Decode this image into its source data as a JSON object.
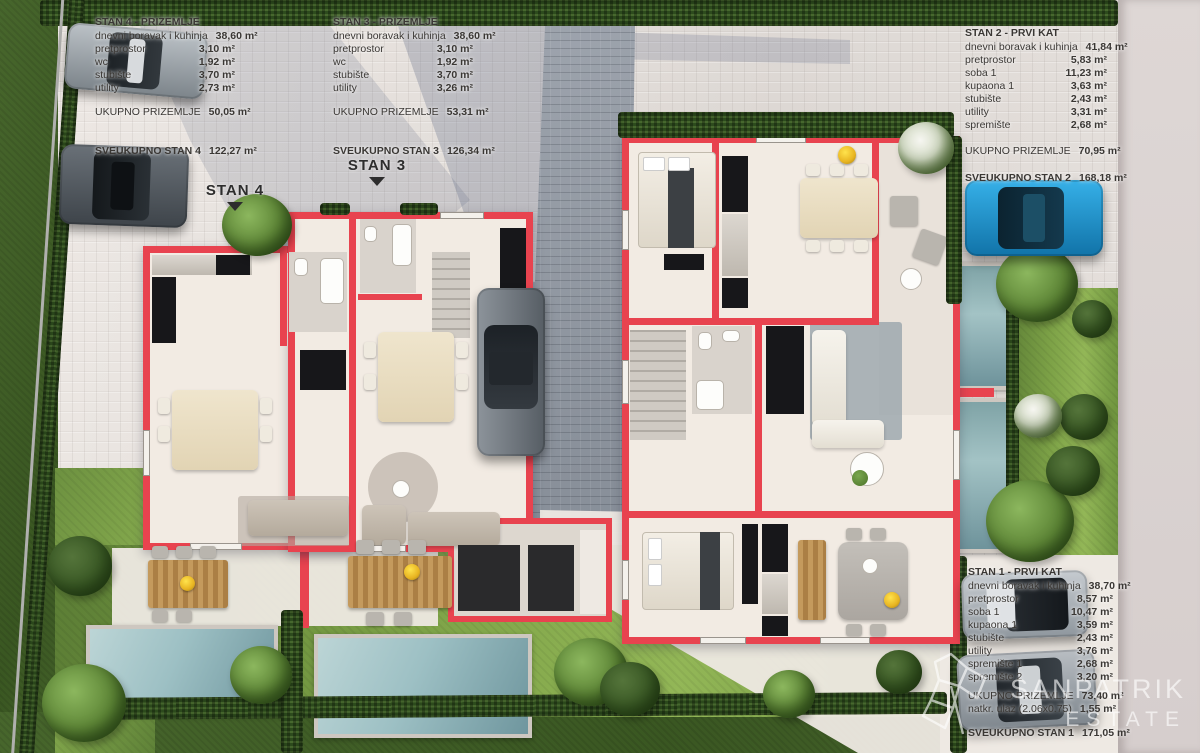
{
  "tables": {
    "stan4": {
      "title": "STAN 4 - PRIZEMLJE",
      "rows": [
        {
          "label": "dnevni boravak i kuhinja",
          "value": "38,60 m²"
        },
        {
          "label": "pretprostor",
          "value": "3,10 m²"
        },
        {
          "label": "wc",
          "value": "1,92 m²"
        },
        {
          "label": "stubište",
          "value": "3,70 m²"
        },
        {
          "label": "utility",
          "value": "2,73 m²"
        }
      ],
      "subtotal": {
        "label": "UKUPNO PRIZEMLJE",
        "value": "50,05 m²"
      },
      "total": {
        "label": "SVEUKUPNO STAN 4",
        "value": "122,27 m²"
      }
    },
    "stan3": {
      "title": "STAN 3 - PRIZEMLJE",
      "rows": [
        {
          "label": "dnevni boravak i kuhinja",
          "value": "38,60 m²"
        },
        {
          "label": "pretprostor",
          "value": "3,10 m²"
        },
        {
          "label": "wc",
          "value": "1,92 m²"
        },
        {
          "label": "stubište",
          "value": "3,70 m²"
        },
        {
          "label": "utility",
          "value": "3,26 m²"
        }
      ],
      "subtotal": {
        "label": "UKUPNO PRIZEMLJE",
        "value": "53,31 m²"
      },
      "total": {
        "label": "SVEUKUPNO STAN 3",
        "value": "126,34 m²"
      }
    },
    "stan2": {
      "title": "STAN 2 - PRVI KAT",
      "rows": [
        {
          "label": "dnevni boravak i kuhinja",
          "value": "41,84 m²"
        },
        {
          "label": "pretprostor",
          "value": "5,83 m²"
        },
        {
          "label": "soba 1",
          "value": "11,23 m²"
        },
        {
          "label": "kupaona 1",
          "value": "3,63 m²"
        },
        {
          "label": "stubište",
          "value": "2,43 m²"
        },
        {
          "label": "utility",
          "value": "3,31 m²"
        },
        {
          "label": "spremište",
          "value": "2,68 m²"
        }
      ],
      "subtotal": {
        "label": "UKUPNO PRIZEMLJE",
        "value": "70,95 m²"
      },
      "total": {
        "label": "SVEUKUPNO STAN 2",
        "value": "168,18 m²"
      }
    },
    "stan1": {
      "title": "STAN 1 - PRVI KAT",
      "rows": [
        {
          "label": "dnevni boravak i kuhinja",
          "value": "38,70 m²"
        },
        {
          "label": "pretprostor",
          "value": "8,57 m²"
        },
        {
          "label": "soba 1",
          "value": "10,47 m²"
        },
        {
          "label": "kupaona 1",
          "value": "3,59 m²"
        },
        {
          "label": "stubište",
          "value": "2,43 m²"
        },
        {
          "label": "utility",
          "value": "3,76 m²"
        },
        {
          "label": "spremište 1",
          "value": "2,68 m²"
        },
        {
          "label": "spremište 2",
          "value": "3,20 m²"
        }
      ],
      "subtotal": {
        "label": "UKUPNO PRIZEMLJE",
        "value": "73,40 m²"
      },
      "extra": {
        "label": "natkr. ulaz  (2.06x0.75)",
        "value": "1,55 m²"
      },
      "total": {
        "label": "SVEUKUPNO STAN 1",
        "value": "171,05 m²"
      }
    }
  },
  "markers": [
    {
      "label": "STAN 4"
    },
    {
      "label": "STAN 3"
    }
  ],
  "watermark": {
    "line1": "SANPATRIK",
    "line2": "ESTATE"
  },
  "palette": {
    "wall_red": "#e8434f",
    "floor_cream": "#f2ebe3",
    "pool_water": "#9dc0c4",
    "hedge_green": "#2d4b1d",
    "grass_green": "#6d9140",
    "paving_light": "#e6e1dd",
    "driveway_grey": "#8a919b",
    "car_blue": "#2fa7e2"
  }
}
